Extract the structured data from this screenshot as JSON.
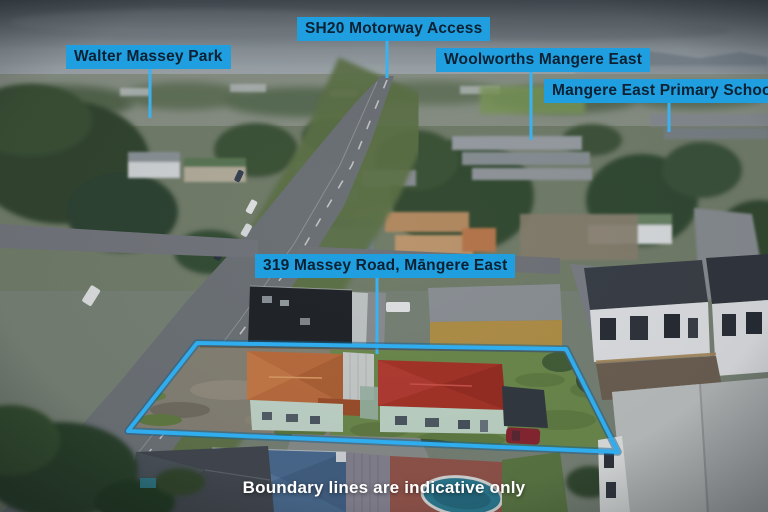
{
  "image": {
    "labels": {
      "park": "Walter Massey Park",
      "motorway": "SH20 Motorway Access",
      "supermarket": "Woolworths Mangere East",
      "school": "Mangere East Primary School",
      "address": "319 Massey Road, Māngere East"
    },
    "disclaimer": "Boundary lines are indicative only",
    "colors": {
      "label_background": "#1f9fdf",
      "label_text": "#0c2133",
      "boundary_line": "#2fadee",
      "leader_line": "#3ab2f0",
      "disclaimer_text": "#ffffff"
    }
  }
}
